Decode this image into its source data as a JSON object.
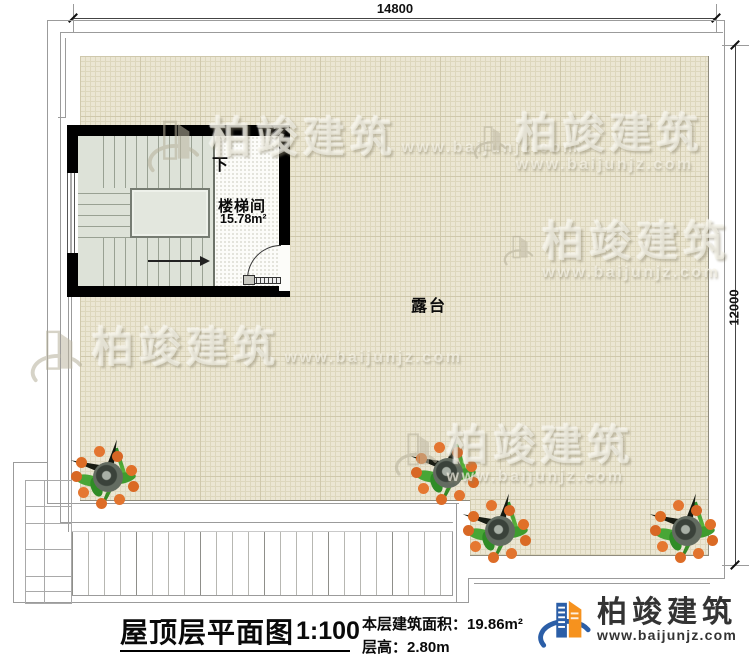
{
  "dimensions": {
    "width_mm": "14800",
    "height_mm": "12000"
  },
  "plan": {
    "terrace_label": "露台",
    "stairwell": {
      "name": "楼梯间",
      "area": "15.78m²",
      "direction_label": "下"
    }
  },
  "title_block": {
    "title": "屋顶层平面图",
    "scale": "1:100",
    "floor_area": "本层建筑面积：19.86m²",
    "floor_height": "层高：2.80m"
  },
  "branding": {
    "company": "柏竣建筑",
    "website": "www.baijunjz.com",
    "colors": {
      "orange": "#f6921e",
      "blue": "#2b5ea7"
    }
  },
  "watermark": {
    "text": "柏竣建筑",
    "url": "www.baijunjz.com"
  },
  "colors": {
    "terrace_fill": "#ebe6d3",
    "stair_fill": "#dde2d8",
    "wall": "#000000"
  }
}
